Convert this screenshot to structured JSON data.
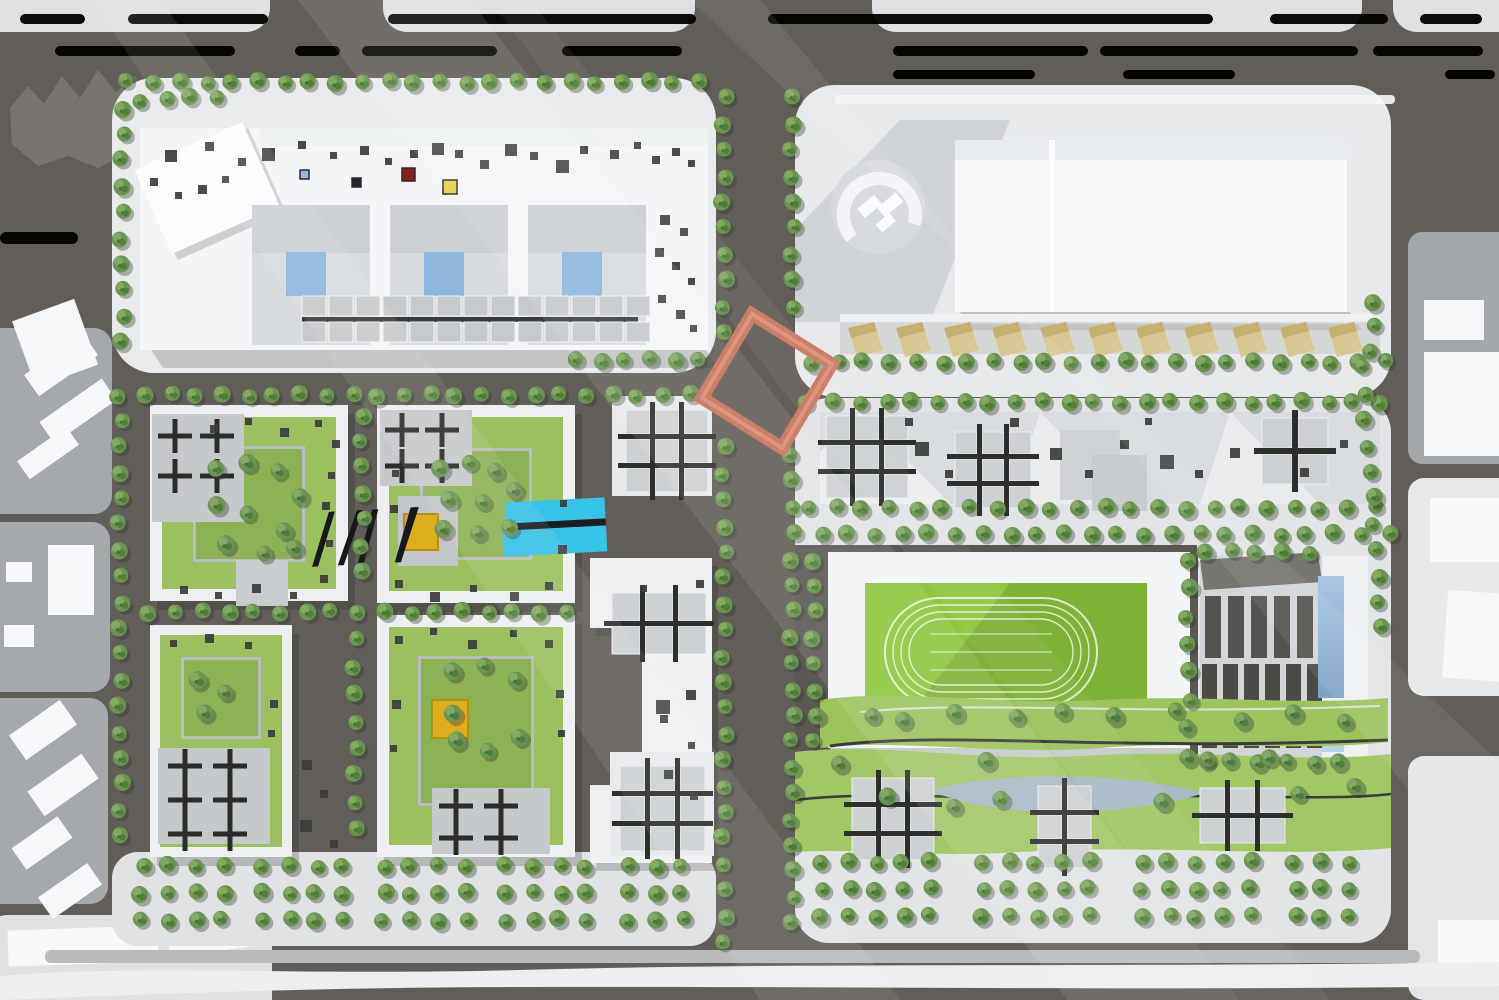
{
  "meta": {
    "type": "masterplan-site-plan-rendering",
    "view": "aerial-top-down",
    "visible_text": "none"
  },
  "palette": {
    "road": "#615e5a",
    "roadDark": "#55524e",
    "blockLight": "#e8eaec",
    "blockLighter": "#e2e4e6",
    "contextGray": "#a6a9ac",
    "contextLight": "#dfe1e3",
    "white": "#f4f6f7",
    "pureWhite": "#fbfcfd",
    "laneWhite": "#eef0f1",
    "median": "#b8babc",
    "treeMain": "#6b9351",
    "treeHi": "#83a963",
    "treeLo": "#547d3d",
    "grass": "#9cc05e",
    "grassDeep": "#8db254",
    "field": "#8fc63e",
    "fieldShade": "#7cae35",
    "marker": "#cd7f6a",
    "markerHi": "#e09c88",
    "cyan": "#35c3e8",
    "yellow": "#dfae1c",
    "skyBlue": "#8fb7dc",
    "glass": "#9dbfdd",
    "pond": "#aab9c7",
    "hashDark": "#2e2e2c",
    "cellLight": "#ced1d3",
    "roofDot": "#3c3c3a",
    "awning": "#d8c68d",
    "unitGray": "#c7cacc",
    "insetGray": "#d9dcde",
    "parkBand": "#9dc35d",
    "parkBand2": "#a2c765",
    "parkingBase": "#d3d6d8",
    "stripeDark": "#4e4c49",
    "terrace": "#c7cacb",
    "padGray": "#c6c9cb",
    "zigzag": "#787571"
  },
  "roads": {
    "lane_stripes": [
      {
        "y": 14,
        "h": 10,
        "segs": [
          [
            20,
            65
          ],
          [
            128,
            140
          ],
          [
            388,
            308
          ],
          [
            768,
            445
          ],
          [
            1270,
            118
          ],
          [
            1420,
            62
          ]
        ]
      },
      {
        "y": 46,
        "h": 10,
        "segs": [
          [
            55,
            180
          ],
          [
            295,
            45
          ],
          [
            362,
            135
          ],
          [
            562,
            120
          ],
          [
            893,
            195
          ],
          [
            1100,
            258
          ],
          [
            1373,
            110
          ]
        ]
      },
      {
        "y": 70,
        "h": 9,
        "segs": [
          [
            893,
            142
          ],
          [
            1123,
            112
          ],
          [
            1445,
            50
          ]
        ]
      },
      {
        "y": 232,
        "h": 12,
        "segs": [
          [
            0,
            78
          ]
        ]
      }
    ],
    "median": {
      "x": 45,
      "y": 950,
      "w": 1375,
      "h": 13
    }
  },
  "vegetation": {
    "rows": [
      {
        "x": 128,
        "y": 82,
        "n": 23,
        "dx": 26,
        "dy": 0
      },
      {
        "x": 122,
        "y": 108,
        "n": 10,
        "dx": 0,
        "dy": 26
      },
      {
        "x": 140,
        "y": 100,
        "n": 4,
        "dx": 26,
        "dy": -1
      },
      {
        "x": 575,
        "y": 360,
        "n": 6,
        "dx": 25,
        "dy": 0
      },
      {
        "x": 118,
        "y": 395,
        "n": 23,
        "dx": 26,
        "dy": 0
      },
      {
        "x": 120,
        "y": 420,
        "n": 17,
        "dx": 0,
        "dy": 26
      },
      {
        "x": 362,
        "y": 415,
        "n": 7,
        "dx": 0,
        "dy": 26
      },
      {
        "x": 355,
        "y": 640,
        "n": 8,
        "dx": 0,
        "dy": 27
      },
      {
        "x": 150,
        "y": 612,
        "n": 17,
        "dx": 26,
        "dy": 0
      },
      {
        "x": 724,
        "y": 98,
        "n": 10,
        "dx": 0,
        "dy": 26
      },
      {
        "x": 724,
        "y": 448,
        "n": 20,
        "dx": 0,
        "dy": 26
      },
      {
        "x": 792,
        "y": 98,
        "n": 9,
        "dx": 0,
        "dy": 26
      },
      {
        "x": 792,
        "y": 455,
        "n": 19,
        "dx": 0,
        "dy": 26
      },
      {
        "x": 812,
        "y": 362,
        "n": 23,
        "dx": 26,
        "dy": 0
      },
      {
        "x": 808,
        "y": 402,
        "n": 23,
        "dx": 26,
        "dy": 0
      },
      {
        "x": 808,
        "y": 508,
        "n": 22,
        "dx": 27,
        "dy": 0
      },
      {
        "x": 821,
        "y": 534,
        "n": 22,
        "dx": 27,
        "dy": 0
      },
      {
        "x": 814,
        "y": 560,
        "n": 8,
        "dx": 0,
        "dy": 26
      },
      {
        "x": 1188,
        "y": 560,
        "n": 8,
        "dx": 0,
        "dy": 28
      },
      {
        "x": 1205,
        "y": 762,
        "n": 6,
        "dx": 27,
        "dy": 0
      },
      {
        "x": 1362,
        "y": 368,
        "n": 11,
        "dx": 2,
        "dy": 26
      },
      {
        "x": 1372,
        "y": 302,
        "n": 3,
        "dx": 0,
        "dy": 24
      },
      {
        "x": 1205,
        "y": 552,
        "n": 5,
        "dx": 26,
        "dy": 0
      }
    ],
    "grids": [
      {
        "x": 142,
        "y": 866,
        "cols": 4,
        "rows": 3,
        "dx": 27,
        "dy": 27
      },
      {
        "x": 262,
        "y": 866,
        "cols": 4,
        "rows": 3,
        "dx": 27,
        "dy": 27
      },
      {
        "x": 384,
        "y": 866,
        "cols": 4,
        "rows": 3,
        "dx": 27,
        "dy": 27
      },
      {
        "x": 506,
        "y": 866,
        "cols": 4,
        "rows": 3,
        "dx": 27,
        "dy": 27
      },
      {
        "x": 628,
        "y": 866,
        "cols": 3,
        "rows": 3,
        "dx": 27,
        "dy": 27
      },
      {
        "x": 822,
        "y": 862,
        "cols": 5,
        "rows": 3,
        "dx": 27,
        "dy": 27
      },
      {
        "x": 982,
        "y": 862,
        "cols": 5,
        "rows": 3,
        "dx": 27,
        "dy": 27
      },
      {
        "x": 1142,
        "y": 862,
        "cols": 5,
        "rows": 3,
        "dx": 27,
        "dy": 27
      },
      {
        "x": 1295,
        "y": 862,
        "cols": 3,
        "rows": 3,
        "dx": 27,
        "dy": 27
      }
    ],
    "scatter": [
      [
        215,
        470
      ],
      [
        245,
        462
      ],
      [
        280,
        472
      ],
      [
        300,
        495
      ],
      [
        215,
        505
      ],
      [
        250,
        515
      ],
      [
        285,
        530
      ],
      [
        225,
        545
      ],
      [
        262,
        552
      ],
      [
        296,
        548
      ],
      [
        440,
        470
      ],
      [
        468,
        462
      ],
      [
        498,
        472
      ],
      [
        450,
        498
      ],
      [
        482,
        502
      ],
      [
        512,
        492
      ],
      [
        445,
        528
      ],
      [
        478,
        534
      ],
      [
        508,
        526
      ],
      [
        200,
        680
      ],
      [
        226,
        694
      ],
      [
        204,
        712
      ],
      [
        450,
        672
      ],
      [
        486,
        664
      ],
      [
        516,
        680
      ],
      [
        455,
        742
      ],
      [
        490,
        750
      ],
      [
        520,
        738
      ],
      [
        452,
        712
      ],
      [
        870,
        716
      ],
      [
        905,
        722
      ],
      [
        955,
        712
      ],
      [
        1015,
        718
      ],
      [
        1065,
        710
      ],
      [
        1115,
        716
      ],
      [
        1175,
        712
      ],
      [
        1240,
        720
      ],
      [
        1295,
        714
      ],
      [
        1345,
        720
      ],
      [
        838,
        764
      ],
      [
        890,
        798
      ],
      [
        955,
        806
      ],
      [
        1000,
        800
      ],
      [
        1160,
        800
      ],
      [
        1300,
        794
      ],
      [
        1355,
        788
      ],
      [
        985,
        760
      ],
      [
        1210,
        760
      ],
      [
        1270,
        756
      ]
    ]
  },
  "hash_clusters": [
    {
      "x": 626,
      "y": 410,
      "cols": 3,
      "rows": 3,
      "cell": 24,
      "gap": 5
    },
    {
      "x": 612,
      "y": 593,
      "cols": 3,
      "rows": 2,
      "cell": 28,
      "gap": 5
    },
    {
      "x": 620,
      "y": 766,
      "cols": 3,
      "rows": 3,
      "cell": 25,
      "gap": 5
    },
    {
      "x": 826,
      "y": 416,
      "cols": 3,
      "rows": 3,
      "cell": 24,
      "gap": 5
    },
    {
      "x": 955,
      "y": 432,
      "cols": 3,
      "rows": 3,
      "cell": 22,
      "gap": 5
    },
    {
      "x": 1262,
      "y": 418,
      "cols": 2,
      "rows": 2,
      "cell": 30,
      "gap": 6
    },
    {
      "x": 852,
      "y": 778,
      "cols": 3,
      "rows": 3,
      "cell": 24,
      "gap": 5
    },
    {
      "x": 1038,
      "y": 786,
      "cols": 2,
      "rows": 3,
      "cell": 24,
      "gap": 5
    },
    {
      "x": 1200,
      "y": 788,
      "cols": 3,
      "rows": 2,
      "cell": 25,
      "gap": 5
    }
  ],
  "plus_clusters": [
    {
      "x": 175,
      "y": 436,
      "cols": 2,
      "rows": 2,
      "sx": 42,
      "sy": 40
    },
    {
      "x": 402,
      "y": 430,
      "cols": 2,
      "rows": 2,
      "sx": 40,
      "sy": 36
    },
    {
      "x": 185,
      "y": 766,
      "cols": 2,
      "rows": 3,
      "sx": 45,
      "sy": 34
    },
    {
      "x": 456,
      "y": 806,
      "cols": 2,
      "rows": 2,
      "sx": 45,
      "sy": 32
    }
  ],
  "roof_dots": [
    [
      165,
      150,
      12
    ],
    [
      205,
      142,
      9
    ],
    [
      238,
      158,
      8
    ],
    [
      262,
      148,
      13
    ],
    [
      298,
      141,
      8
    ],
    [
      330,
      152,
      7
    ],
    [
      360,
      146,
      9
    ],
    [
      385,
      158,
      7
    ],
    [
      410,
      150,
      8
    ],
    [
      432,
      143,
      12
    ],
    [
      455,
      150,
      8
    ],
    [
      480,
      160,
      9
    ],
    [
      505,
      144,
      12
    ],
    [
      530,
      152,
      8
    ],
    [
      556,
      160,
      13
    ],
    [
      580,
      146,
      8
    ],
    [
      610,
      150,
      9
    ],
    [
      634,
      142,
      7
    ],
    [
      652,
      156,
      8
    ],
    [
      672,
      148,
      8
    ],
    [
      688,
      160,
      7
    ],
    [
      150,
      178,
      8
    ],
    [
      175,
      192,
      7
    ],
    [
      198,
      185,
      9
    ],
    [
      222,
      176,
      7
    ],
    [
      660,
      215,
      10
    ],
    [
      680,
      228,
      8
    ],
    [
      655,
      248,
      9
    ],
    [
      672,
      262,
      8
    ],
    [
      688,
      278,
      7
    ],
    [
      658,
      295,
      8
    ],
    [
      676,
      310,
      9
    ],
    [
      690,
      325,
      7
    ],
    [
      915,
      442,
      14
    ],
    [
      945,
      470,
      8
    ],
    [
      1050,
      448,
      12
    ],
    [
      1085,
      470,
      8
    ],
    [
      1120,
      440,
      9
    ],
    [
      1160,
      455,
      14
    ],
    [
      1195,
      470,
      8
    ],
    [
      1230,
      448,
      10
    ],
    [
      1300,
      468,
      9
    ],
    [
      1340,
      440,
      8
    ],
    [
      905,
      418,
      8
    ],
    [
      1010,
      418,
      9
    ],
    [
      1145,
      418,
      7
    ],
    [
      686,
      690,
      10
    ],
    [
      660,
      715,
      8
    ],
    [
      688,
      742,
      7
    ],
    [
      664,
      770,
      9
    ],
    [
      690,
      792,
      8
    ],
    [
      656,
      700,
      14
    ],
    [
      696,
      580,
      8
    ],
    [
      640,
      585,
      7
    ],
    [
      210,
      425,
      8
    ],
    [
      245,
      418,
      7
    ],
    [
      280,
      428,
      9
    ],
    [
      315,
      420,
      7
    ],
    [
      332,
      440,
      8
    ],
    [
      328,
      472,
      7
    ],
    [
      322,
      502,
      8
    ],
    [
      326,
      540,
      7
    ],
    [
      320,
      575,
      8
    ],
    [
      180,
      586,
      8
    ],
    [
      215,
      592,
      7
    ],
    [
      252,
      584,
      9
    ],
    [
      290,
      592,
      7
    ],
    [
      395,
      580,
      8
    ],
    [
      430,
      592,
      10
    ],
    [
      470,
      585,
      7
    ],
    [
      510,
      592,
      9
    ],
    [
      545,
      582,
      8
    ],
    [
      558,
      545,
      9
    ],
    [
      560,
      500,
      7
    ],
    [
      392,
      470,
      7
    ],
    [
      390,
      505,
      8
    ],
    [
      170,
      640,
      7
    ],
    [
      205,
      634,
      9
    ],
    [
      245,
      642,
      7
    ],
    [
      270,
      700,
      8
    ],
    [
      268,
      730,
      7
    ],
    [
      395,
      636,
      8
    ],
    [
      430,
      628,
      7
    ],
    [
      468,
      640,
      9
    ],
    [
      510,
      630,
      7
    ],
    [
      545,
      640,
      8
    ],
    [
      556,
      690,
      8
    ],
    [
      558,
      730,
      7
    ],
    [
      392,
      700,
      9
    ],
    [
      390,
      745,
      7
    ],
    [
      302,
      760,
      10
    ],
    [
      320,
      790,
      8
    ],
    [
      300,
      820,
      12
    ],
    [
      330,
      840,
      8
    ]
  ],
  "accent_dots": [
    {
      "x": 402,
      "y": 168,
      "s": 13,
      "c": "#8a1f1c"
    },
    {
      "x": 443,
      "y": 180,
      "s": 14,
      "c": "#e6d24a"
    },
    {
      "x": 300,
      "y": 170,
      "s": 9,
      "c": "#9cb6e4"
    },
    {
      "x": 352,
      "y": 178,
      "s": 9,
      "c": "#20242b"
    }
  ],
  "unit_rows": [
    {
      "x": 302,
      "y": 296,
      "cols": 13,
      "cw": 24,
      "ch": 20,
      "gap": 3
    },
    {
      "x": 302,
      "y": 322,
      "cols": 13,
      "cw": 24,
      "ch": 20,
      "gap": 3
    }
  ],
  "awnings": [
    848,
    896,
    944,
    992,
    1040,
    1088,
    1136,
    1184,
    1232,
    1280,
    1328
  ],
  "features": {
    "highlight_marker": "selected-parcel-outline (rotated square, salmon)",
    "sports_field": "running-track field",
    "pool": "cyan canopy/pool structure",
    "pond": "curved park pond"
  }
}
